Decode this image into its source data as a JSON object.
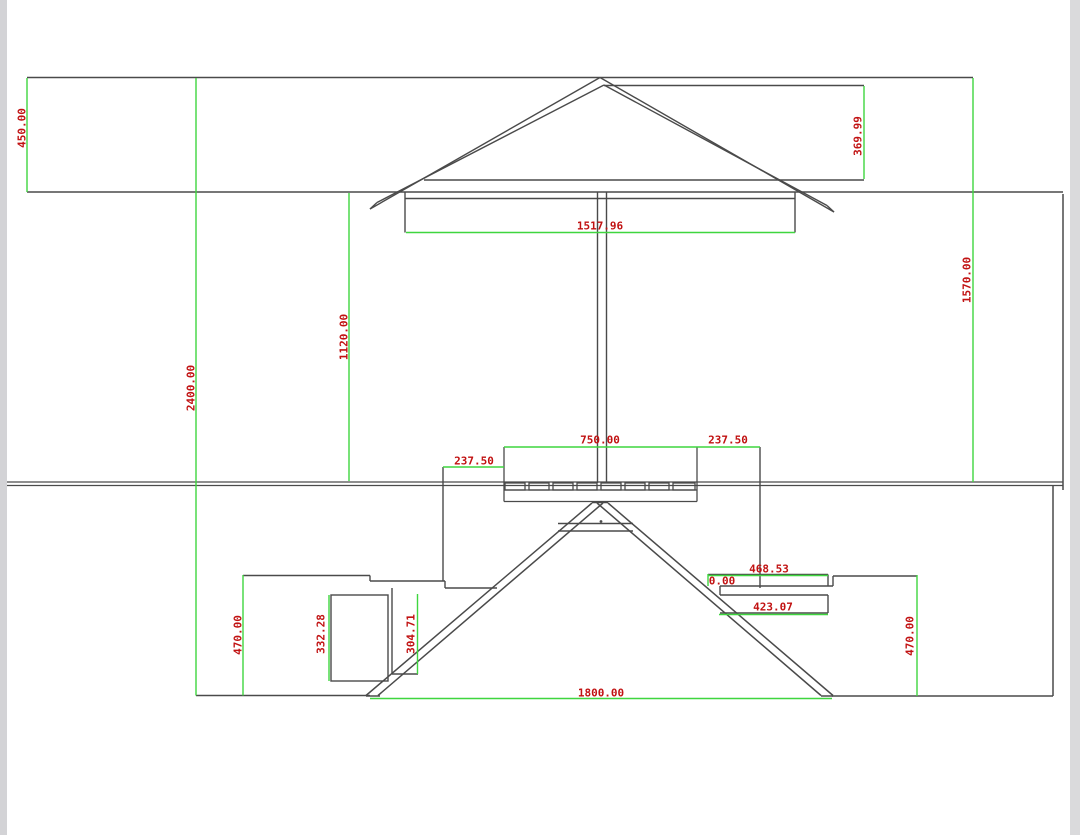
{
  "meta": {
    "drawing_type": "CAD dimensioned side-elevation drawing",
    "subject": "picnic table with umbrella, benches and A-frame legs",
    "units": "mm"
  },
  "colors": {
    "background": "#ffffff",
    "drawing_line": "#4a4a4a",
    "dimension_line": "#3fd63f",
    "dimension_text": "#c11212"
  },
  "dimensions": {
    "umbrella_overhang_height": "450.00",
    "canopy_edge_height": "369.99",
    "canopy_width": "1517.96",
    "umbrella_to_table_height": "1570.00",
    "canopy_to_table_height": "1120.00",
    "overall_height": "2400.00",
    "tabletop_width": "750.00",
    "tabletop_overhang_left": "237.50",
    "tabletop_overhang_right": "237.50",
    "seat_width_right": "468.53",
    "seat_zero_offset": "0.00",
    "seat_frame_width_right": "423.07",
    "seat_height_left": "470.00",
    "seat_support_height": "332.28",
    "seat_brace_height": "304.71",
    "seat_height_right": "470.00",
    "base_span": "1800.00"
  }
}
